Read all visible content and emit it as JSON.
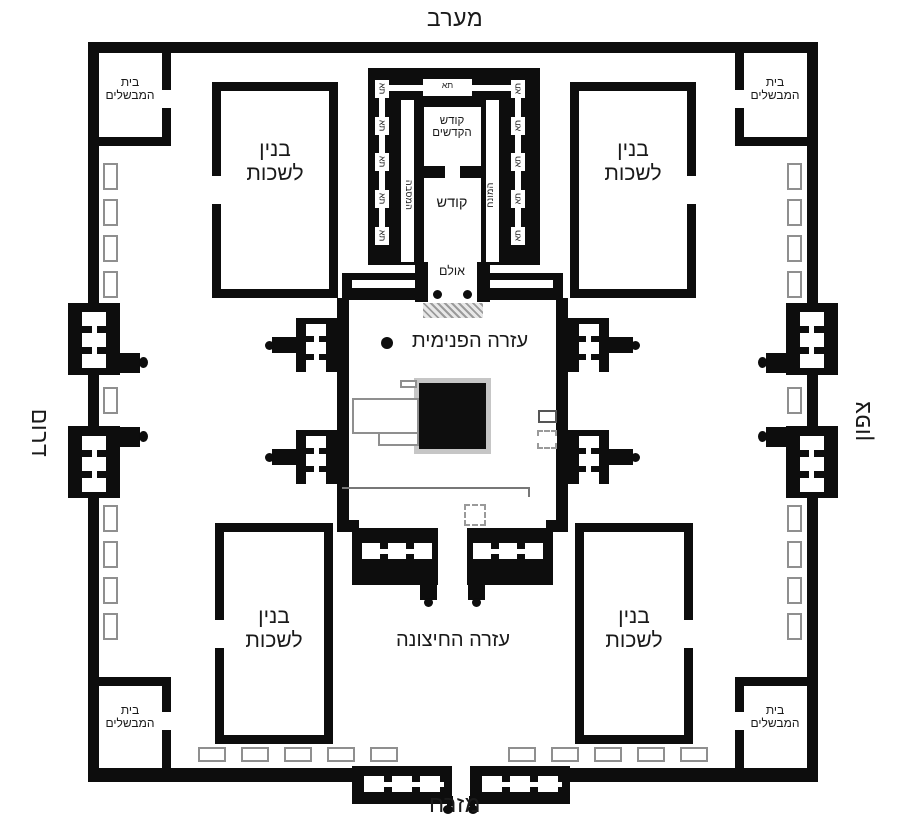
{
  "directions": {
    "west": "מערב",
    "east": "מזרח",
    "south": "דרום",
    "north": "צפון"
  },
  "rooms": {
    "cooking_house": {
      "line1": "בית",
      "line2": "המבשלים"
    },
    "chambers_building": {
      "line1": "בנין",
      "line2": "לשכות"
    },
    "holy_of_holies": {
      "line1": "קודש",
      "line2": "הקדשים"
    },
    "holy": "קודש",
    "porch": "אולם",
    "cell": "תא",
    "winding_passage": "המסבה",
    "free_space": "המונח",
    "inner_court": "עזרה הפנימית",
    "outer_court": "עזרה החיצונה"
  },
  "colors": {
    "wall": "#0d0d0d",
    "text": "#1a1a1a",
    "outline_gray": "#8f8f8f",
    "steps_hatch": "#9b9b9b",
    "altar_border": "#c6c6c6"
  }
}
